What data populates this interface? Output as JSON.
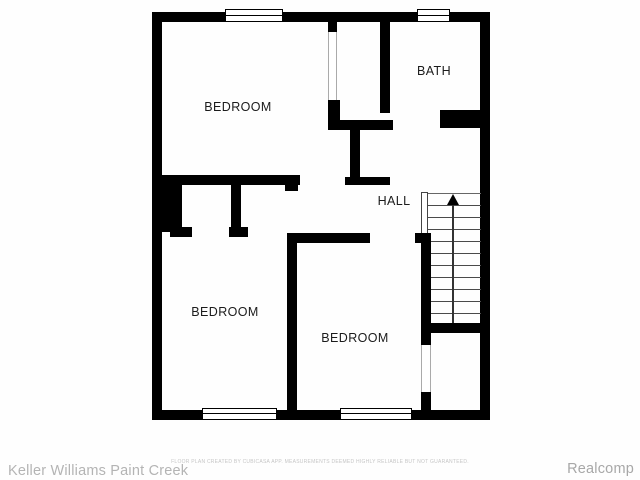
{
  "floor_plan": {
    "rooms": [
      {
        "id": "bedroom-top-left",
        "label": "BEDROOM"
      },
      {
        "id": "bath",
        "label": "BATH"
      },
      {
        "id": "hall",
        "label": "HALL"
      },
      {
        "id": "bedroom-bottom-left",
        "label": "BEDROOM"
      },
      {
        "id": "bedroom-bottom-middle",
        "label": "BEDROOM"
      }
    ],
    "stairs": {
      "direction": "up",
      "arrow_icon": "up-arrow"
    },
    "colors": {
      "wall": "#000000",
      "label": "#1b1b1b",
      "background": "#fefefe"
    }
  },
  "footer": {
    "left_brand": "Keller Williams Paint Creek",
    "disclaimer": "FLOOR PLAN CREATED BY CUBICASA APP. MEASUREMENTS DEEMED HIGHLY RELIABLE BUT NOT GUARANTEED.",
    "right_brand": "Realcomp"
  }
}
